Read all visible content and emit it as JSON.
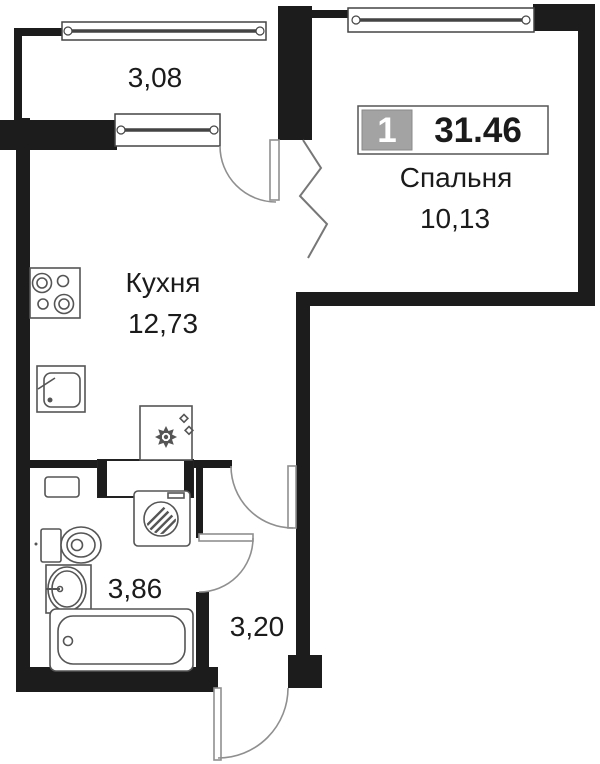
{
  "title": "Floor plan of 1-room apartment",
  "unit_badge": {
    "rooms_count": "1",
    "total_area": "31.46"
  },
  "rooms": {
    "balcony": {
      "area": "3,08"
    },
    "kitchen": {
      "name": "Кухня",
      "area": "12,73"
    },
    "bedroom": {
      "name": "Спальня",
      "area": "10,13"
    },
    "bathroom": {
      "area": "3,86"
    },
    "hallway": {
      "area": "3,20"
    }
  },
  "fixtures": {
    "stove": "stove-icon",
    "kitchen_sink": "kitchen-sink-icon",
    "fridge": "fridge-icon",
    "washing_machine": "washing-machine-icon",
    "toilet": "toilet-icon",
    "bathroom_sink": "bathroom-sink-icon",
    "bathtub": "bathtub-icon",
    "shelf": "shelf-icon"
  },
  "colors": {
    "wall": "#1c1c1c",
    "fixture": "#555555",
    "arc": "#8f8f8f",
    "badge_gray": "#a3a3a3",
    "text": "#1b1b1b",
    "background": "#ffffff"
  }
}
